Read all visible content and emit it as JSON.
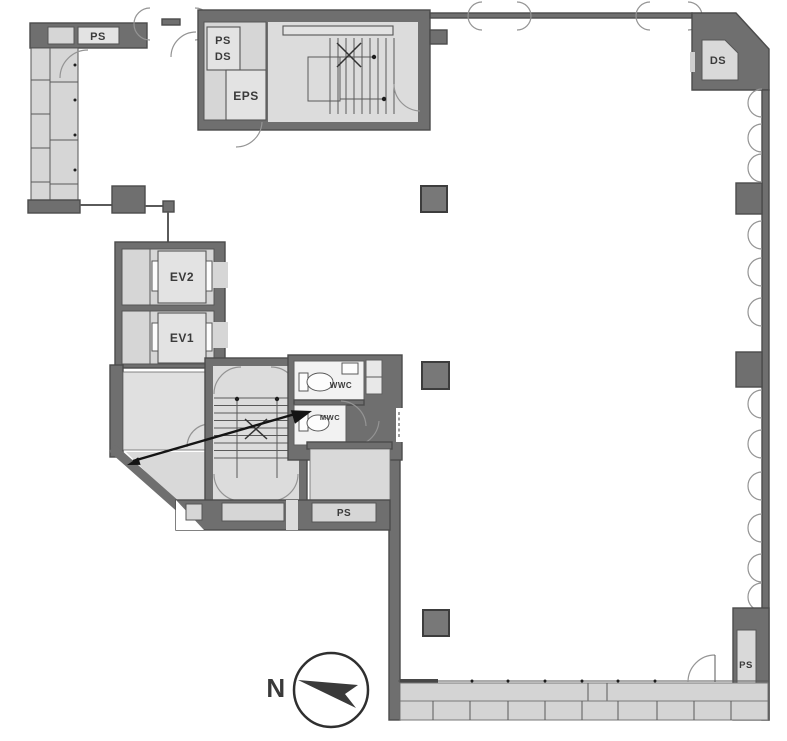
{
  "floor_plan": {
    "labels": {
      "ps_top_left": "PS",
      "ps_ds_line1": "PS",
      "ps_ds_line2": "DS",
      "eps": "EPS",
      "ds_corner": "DS",
      "ev2": "EV2",
      "ev1": "EV1",
      "wwc": "WWC",
      "mwc": "MWC",
      "ps_core": "PS",
      "ps_bottom_right": "PS",
      "north": "N"
    },
    "colors": {
      "wall": "#6f6f6f",
      "wall_outline": "#4b4b4b",
      "room_fill": "#d6d6d6",
      "floor_fill": "#dcdcdc",
      "fixture_fill": "#f2f2f2",
      "ink": "#3a3a3a",
      "background": "#ffffff"
    }
  }
}
